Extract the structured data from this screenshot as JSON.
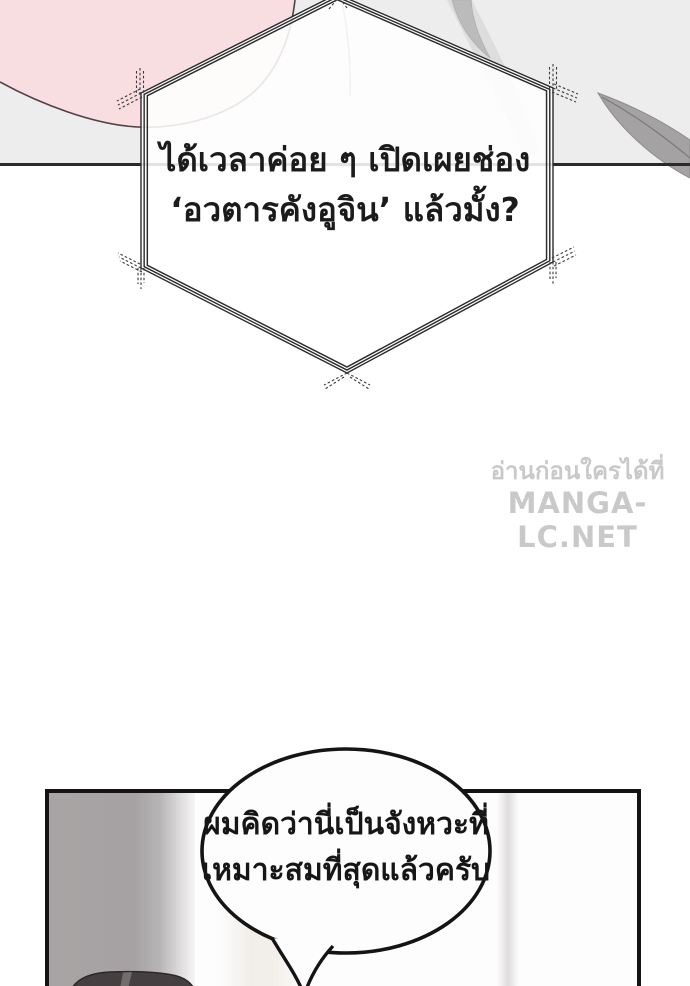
{
  "page": {
    "width": 690,
    "height": 986,
    "background": "#ffffff"
  },
  "top_panel": {
    "background": "#ededed",
    "divider_color": "#2a2a2a",
    "pink_blob_color": "#f8dde1",
    "pink_outline_color": "#4e4247",
    "blade_color": "#a5a2a3",
    "blade_edge_color": "#7c7979"
  },
  "hex_bubble": {
    "fill": "rgba(255,255,255,0.87)",
    "border_color": "#2b2b2b",
    "text_color": "#1b1b1b",
    "line1": "ได้เวลาค่อย ๆ เปิดเผยช่อง",
    "line2": "‘อวตารคังอูจิน’ แล้วมั้ง?"
  },
  "watermark": {
    "color": "#c9c9c9",
    "line1": "อ่านก่อนใครได้ที่",
    "line2": "MANGA-LC.NET"
  },
  "bottom_panel": {
    "border_color": "#141414",
    "background": "#fdfdfd",
    "wall_color": "#a7a3a4",
    "stripe_color": "#f2eeea",
    "hair_color": "#453f41",
    "hair_highlight_color": "#8b8486",
    "bubble": {
      "fill": "#fdfdfd",
      "border_color": "#141414",
      "text_color": "#161616",
      "line1": "ผมคิดว่านี่เป็นจังหวะที่",
      "line2": "เหมาะสมที่สุดแล้วครับ"
    }
  }
}
